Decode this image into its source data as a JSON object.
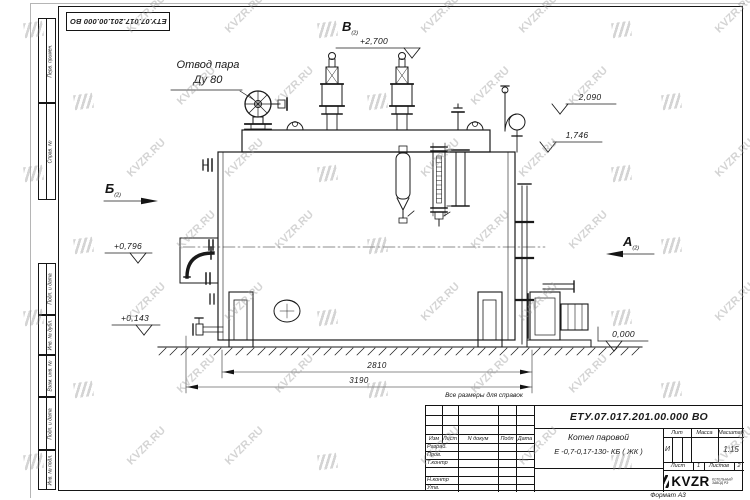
{
  "meta": {
    "background": "#ffffff",
    "line_color": "#1a1a1a",
    "watermark_color": "#9a9a9a",
    "watermark_text": "KVZR.RU"
  },
  "stamp_top": "ЕТУ.07.017.201.00.000  ВО",
  "labels": {
    "steam_outlet_line1": "Отвод пара",
    "steam_outlet_line2": "Ду 80",
    "note": "Все размеры для справок",
    "format": "Формат А3"
  },
  "views": {
    "a": "А",
    "b": "Б",
    "v": "В",
    "sheet_ref": "(2)"
  },
  "elevations": {
    "e2700": "+2,700",
    "e2090": "2,090",
    "e1746": "1,746",
    "e0796": "+0,796",
    "e0143": "+0,143",
    "e0000": "0,000"
  },
  "dimensions": {
    "d2810": "2810",
    "d3190": "3190"
  },
  "frame_columns": [
    "Перв. примен.",
    "Справ. №",
    "Подп. и дата",
    "Инв. № дубл.",
    "Взам. инв. №",
    "Подп. и дата",
    "Инв. № подл."
  ],
  "title_block": {
    "doc_number": "ЕТУ.07.017.201.00.000  ВО",
    "name_line1": "Котел паровой",
    "name_line2": "Е -0,7-0,17-130- КБ ( ЖК )",
    "header_cols": {
      "izm": "Изм",
      "list": "Лист",
      "ndoc": "N докум",
      "podp": "Подп",
      "data": "Дата"
    },
    "rows": [
      "Разраб.",
      "Пров.",
      "Т.контр",
      "",
      "Н.контр",
      "Утв."
    ],
    "lit_label": "Лит",
    "massa_label": "Масса",
    "masshtab_label": "Масштаб",
    "lit_value": "И",
    "scale_value": "1:15",
    "sheet_label": "Лист",
    "sheet_value": "1",
    "sheets_label": "Листов",
    "sheets_value": "2",
    "logo_text": "KVZR",
    "logo_sub1": "КОТЕЛЬНЫЙ",
    "logo_sub2": "ЗАВОД РЭ"
  }
}
